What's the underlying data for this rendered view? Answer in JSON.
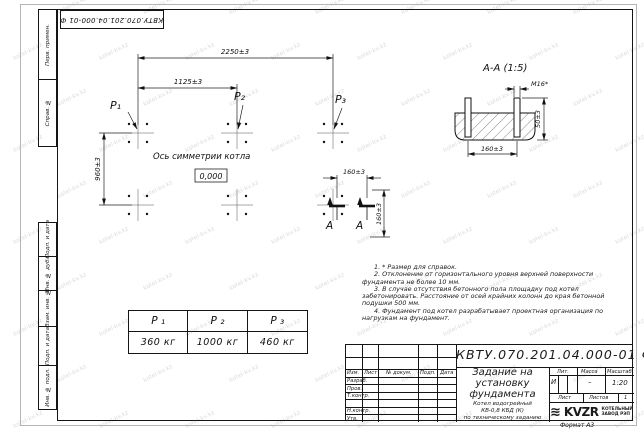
{
  "stamp": {
    "number_rotated": "КВТУ.070.201.04.000-01 Ф"
  },
  "watermark": {
    "text": "kotel-kv.kz"
  },
  "sidebar": {
    "top": [
      "Перв. примен.",
      "Справ. №"
    ],
    "bottom": [
      "Подп. и дата",
      "Инв. № дубл.",
      "Взам. инв. №",
      "Подп. и дата",
      "Инв. № подл."
    ]
  },
  "plan": {
    "dim_total": "2250±3",
    "dim_half": "1125±3",
    "dim_depth": "960±3",
    "dim_cut_h": "160±3",
    "dim_cut_v": "160±3",
    "p1": "P₁",
    "p2": "P₂",
    "p3": "P₃",
    "axis_label": "Ось симметрии котла",
    "level": "0,000",
    "cut_letter": "А"
  },
  "section": {
    "title": "А-А (1:5)",
    "dim_thread": "М16*",
    "dim_height": "50±3",
    "dim_spacing": "160±3"
  },
  "notes": [
    "1. * Размер для справок.",
    "2. Отклонение от горизонтального уровня верхней поверхности фундамента не более 10 мм.",
    "3. В случае отсутствия бетонного пола площадку под котел забетонировать. Расстояние от осей крайних колонн до края бетонной подушки 500 мм.",
    "4. Фундамент под котел разрабатывает проектная организация по нагрузкам на фундамент."
  ],
  "load_table": {
    "headers": [
      "P ₁",
      "P ₂",
      "P ₃"
    ],
    "values": [
      "360  кг",
      "1000  кг",
      "460  кг"
    ]
  },
  "title_block": {
    "doc_number": "КВТУ.070.201.04.000-01 Ф",
    "title_lines": [
      "Задание на",
      "установку",
      "фундамента"
    ],
    "product_lines": [
      "Котел водогрейный",
      "КВ-0,8 КБД (К)",
      "по техническому заданию"
    ],
    "cols": [
      "Изм.",
      "Лист",
      "№ докум.",
      "Подп.",
      "Дата"
    ],
    "rows": [
      "Разраб.",
      "Пров.",
      "Т.контр.",
      "Н.контр.",
      "Утв."
    ],
    "lit_label": "Лит.",
    "mass_label": "Масса",
    "scale_label": "Масштаб",
    "lit_value": "И",
    "mass_value": "–",
    "scale_value": "1:20",
    "sheet_label": "Лист",
    "sheets_label": "Листов",
    "sheets_value": "1",
    "logo_icon_char": "≋",
    "logo_text": "KVZR",
    "org_lines": [
      "КОТЕЛЬНЫЙ",
      "ЗАВОД РЭП"
    ],
    "format_label": "Формат А3"
  }
}
